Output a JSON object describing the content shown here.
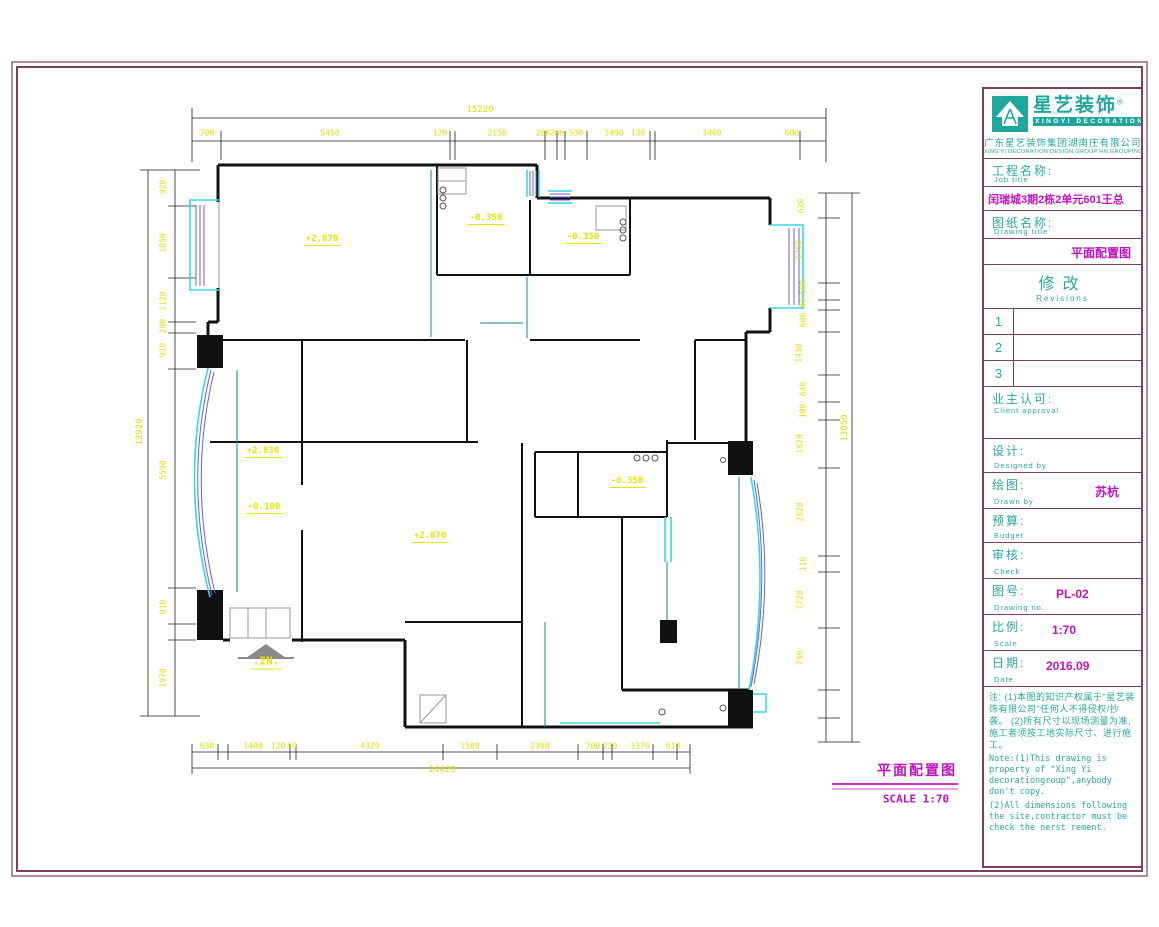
{
  "plan": {
    "levels": {
      "l1": "+2.870",
      "l2": "-0.350",
      "l3": "-0.350",
      "l4": "+2.830",
      "l5": "-0.180",
      "l6": "+2.870",
      "l7": "-0.350"
    },
    "entrance": ".IN.",
    "dims": {
      "top": {
        "overall": "15220",
        "segments": [
          "700",
          "5450",
          "120",
          "2150",
          "280",
          "200",
          "530",
          "1490",
          "130",
          "3460",
          "600"
        ]
      },
      "bottom": {
        "overall": "14420",
        "segments": [
          "630",
          "1480",
          "120",
          "50",
          "4320",
          "1580",
          "2390",
          "700",
          "230",
          "1370",
          "610"
        ]
      },
      "left": {
        "overall": "13920",
        "segments": [
          "920",
          "1850",
          "1120",
          "280",
          "910",
          "5590",
          "910",
          "1970"
        ]
      },
      "right": {
        "overall": "13050",
        "segments": [
          "620",
          "1750",
          "500",
          "90",
          "600",
          "1430",
          "640",
          "180",
          "1820",
          "2520",
          "110",
          "1720",
          "730"
        ]
      }
    }
  },
  "footer": {
    "title": "平面配置图",
    "scale": "SCALE  1:70"
  },
  "titleblock": {
    "brand_cn": "星艺装饰",
    "brand_reg": "®",
    "brand_en": "XINGYI DECORATION",
    "company_cn": "广东星艺装饰集团湖南庄有限公司",
    "company_en": "XING'YI DECORATION DESIGN GROUP HN.GROUPING",
    "job": {
      "label_cn": "工程名称:",
      "label_en": "Job title",
      "value": "闰瑞城3期2栋2单元601王总"
    },
    "drawing": {
      "label_cn": "图纸名称:",
      "label_en": "Drawing title",
      "value": "平面配置图"
    },
    "revisions": {
      "label_cn": "修改",
      "label_en": "Revisions",
      "rows": [
        "1",
        "2",
        "3"
      ]
    },
    "client": {
      "label_cn": "业主认可:",
      "label_en": "Client approval"
    },
    "designer": {
      "label_cn": "设计:",
      "label_en": "Designed by"
    },
    "drawn": {
      "label_cn": "绘图:",
      "label_en": "Drawn by",
      "value": "苏杭"
    },
    "budget": {
      "label_cn": "预算:",
      "label_en": "Budget"
    },
    "check": {
      "label_cn": "审核:",
      "label_en": "Check"
    },
    "drawing_no": {
      "label_cn": "图号:",
      "label_en": "Drawing no.",
      "value": "PL-02"
    },
    "scale": {
      "label_cn": "比例:",
      "label_en": "Scale",
      "value": "1:70"
    },
    "date": {
      "label_cn": "日期:",
      "label_en": "Date",
      "value": "2016.09"
    },
    "notes_cn": "注: (1)本图的知识产权属于\"星艺装饰有限公司\"任何人不得侵权/抄袭。 (2)所有尺寸以现场测量为准, 施工者须按工地实际尺寸、进行施工。",
    "notes_en1": "Note:(1)This drawing is property of \"Xing Yi decorationgroup\",anybody don't copy.",
    "notes_en2": "(2)All dimensions following the site,contractor must be check the nerst rement."
  },
  "colors": {
    "border_maroon": "#7c3f5c",
    "teal_text": "#2aa8a0",
    "magenta": "#c013c0",
    "dim_yellow": "#e8e400",
    "window_cyan": "#35d8ea",
    "window_blue": "#6b5fd6",
    "track_teal": "#0a8a8a"
  }
}
